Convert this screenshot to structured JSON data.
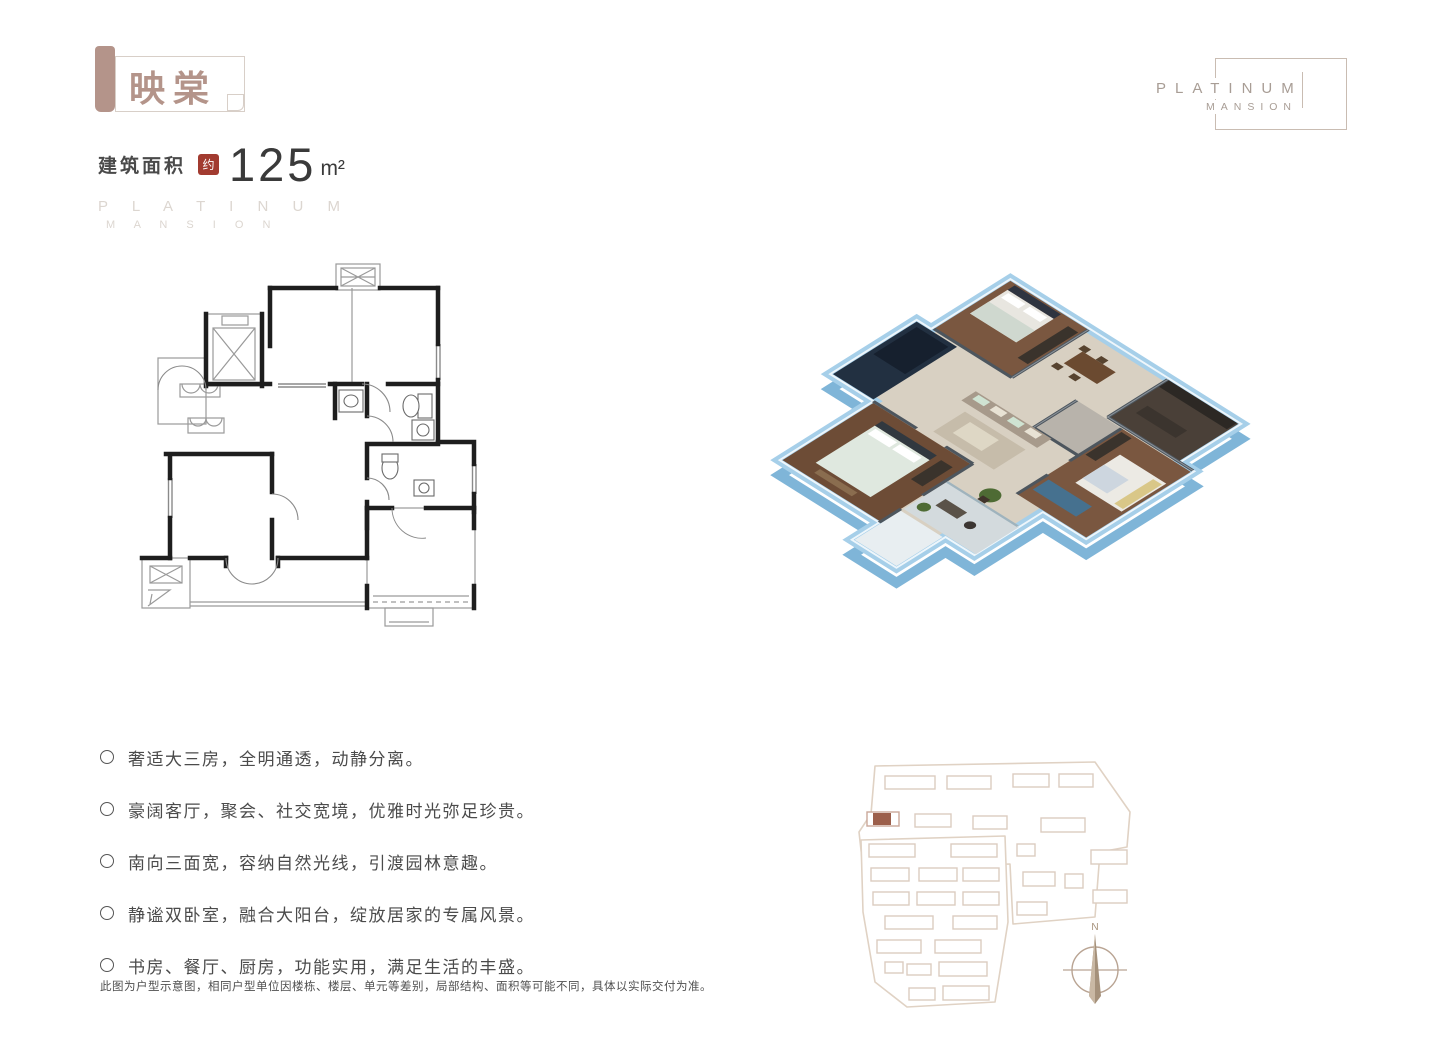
{
  "header": {
    "banner_title": "映棠",
    "area_label": "建筑面积",
    "area_seal": "约",
    "area_value": "125",
    "area_unit": "m²",
    "watermark": {
      "line1": "P L A T I N U M",
      "line2": "M A N S I O N"
    }
  },
  "brand_box": {
    "line1": "PLATINUM",
    "line2": "MANSION"
  },
  "features": {
    "items": [
      "奢适大三房，全明通透，动静分离。",
      "豪阔客厅，聚会、社交宽境，优雅时光弥足珍贵。",
      "南向三面宽，容纳自然光线，引渡园林意趣。",
      "静谧双卧室，融合大阳台，绽放居家的专属风景。",
      "书房、餐厅、厨房，功能实用，满足生活的丰盛。"
    ]
  },
  "disclaimer": "此图为户型示意图，相同户型单位因楼栋、楼层、单元等差别，局部结构、面积等可能不同，具体以实际交付为准。",
  "site_plan": {
    "compass_label": "N"
  },
  "colors": {
    "accent_rose": "#b4948a",
    "seal_red": "#a23b30",
    "text_dark": "#3a3a3a",
    "watermark_gray": "#dcd6d0",
    "brand_gray": "#a89d95",
    "plan_line": "#1e1e1e",
    "wall_blue": "#a6cfe9",
    "highlight_building": "#9c5f4b",
    "site_outline": "#e0d2c4"
  }
}
